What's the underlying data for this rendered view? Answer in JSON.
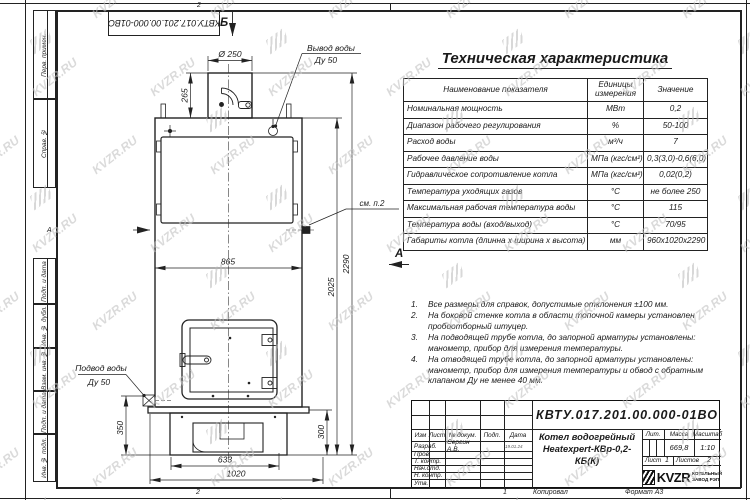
{
  "watermark": {
    "text": "KVZR.RU"
  },
  "frame": {
    "doc_number_top": "КВТУ.017.201.00.000-01ВО",
    "left_margin_labels": [
      "Перв. примен.",
      "Справ. №",
      "Подп. и дата",
      "Инв. № дубл.",
      "Взам. инв. №",
      "Подп. и дата",
      "Инв. № подл."
    ],
    "zones": {
      "top": "2",
      "bottom_left": "2",
      "bottom_right": "1",
      "row_letter": "А"
    },
    "copy_label": "Копировал",
    "format_label": "Формат А3"
  },
  "spec_table": {
    "title": "Техническая характеристика",
    "columns": [
      "Наименование показателя",
      "Единицы измерения",
      "Значение"
    ],
    "rows": [
      [
        "Номинальная мощность",
        "МВт",
        "0,2"
      ],
      [
        "Диапазон рабочего регулирования",
        "%",
        "50-100"
      ],
      [
        "Расход воды",
        "м³/ч",
        "7"
      ],
      [
        "Рабочее давление воды",
        "МПа (кгс/см²)",
        "0,3(3,0)-0,6(6,0)"
      ],
      [
        "Гидравлическое сопротивление котла",
        "МПа (кгс/см²)",
        "0,02(0,2)"
      ],
      [
        "Температура уходящих газов",
        "°С",
        "не более 250"
      ],
      [
        "Максимальная рабочая температура воды",
        "°С",
        "115"
      ],
      [
        "Температура воды (вход/выход)",
        "°С",
        "70/95"
      ],
      [
        "Габариты котла (длинна х ширина х высота)",
        "мм",
        "960х1020х2290"
      ]
    ]
  },
  "notes": [
    {
      "num": "1.",
      "text": "Все размеры для справок, допустимые отклонения ±100 мм."
    },
    {
      "num": "2.",
      "text": "На боковой стенке котла в области топочной камеры установлен пробоотборный штуцер."
    },
    {
      "num": "3.",
      "text": "На подводящей трубе котла, до запорной арматуры установлены: манометр, прибор для измерения температуры."
    },
    {
      "num": "4.",
      "text": "На отводящей трубе котла, до запорной арматуры установлены: манометр, прибор для измерения температуры и обвод с обратным клапаном Ду не менее 40 мм."
    }
  ],
  "drawing": {
    "labels": {
      "view_b": "Б",
      "view_a": "А",
      "see_note": "см. п.2",
      "water_out_1": "Вывод воды",
      "water_out_2": "Ду 50",
      "water_in_1": "Подвод воды",
      "water_in_2": "Ду 50"
    },
    "dims": {
      "chimney_dia": "Ø 250",
      "chimney_h": "265",
      "body_w": "865",
      "h_body": "2025",
      "h_total": "2290",
      "inlet_h": "350",
      "base_h": "300",
      "base_w1": "633",
      "base_w2": "1020"
    }
  },
  "title_block": {
    "doc_number": "КВТУ.017.201.00.000-01ВО",
    "product_name_1": "Котел водогрейный",
    "product_name_2": "Heatexpert-КВр-0,2-КБ(К)",
    "headers": {
      "izm": "Изм",
      "list": "Лист",
      "doc": "№ докум.",
      "podp": "Подп.",
      "data": "Дата",
      "lit": "Лит.",
      "mass": "Масса",
      "scale": "Масштаб",
      "sheet": "Лист",
      "sheets": "Листов"
    },
    "rows": [
      [
        "Разраб.",
        "Сергин А.В."
      ],
      [
        "Пров.",
        ""
      ],
      [
        "Т. контр.",
        ""
      ],
      [
        "Нач.отд.",
        ""
      ],
      [
        "Н. контр.",
        ""
      ],
      [
        "Утв.",
        ""
      ]
    ],
    "date_value": "19.01.24",
    "mass_value": "669,8",
    "scale_value": "1:10",
    "sheet_value": "1",
    "sheets_value": "2",
    "logo_word": "KVZR",
    "logo_sub_1": "КОТЕЛЬНЫЙ",
    "logo_sub_2": "ЗАВОД РЭП"
  }
}
